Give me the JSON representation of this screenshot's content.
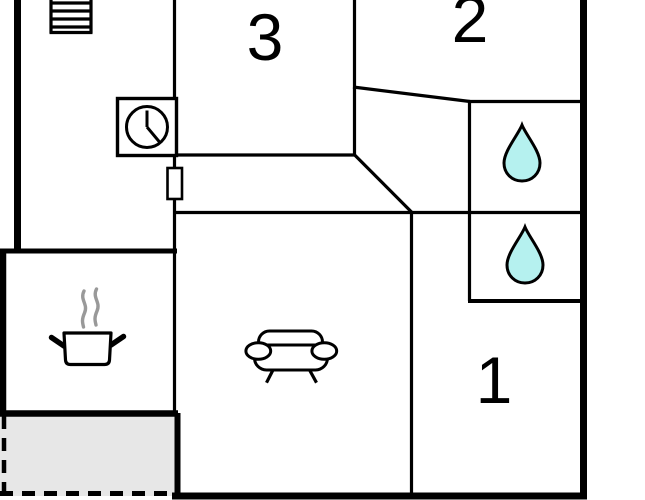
{
  "plan": {
    "name": "apartment-floor-plan",
    "rooms": [
      {
        "id": "room-1",
        "label": "1"
      },
      {
        "id": "room-2",
        "label": "2"
      },
      {
        "id": "room-3",
        "label": "3"
      }
    ],
    "icons": [
      {
        "name": "stairs-icon",
        "area": "entry-hall"
      },
      {
        "name": "clock-icon",
        "area": "entry-hall"
      },
      {
        "name": "door-icon",
        "area": "hallway"
      },
      {
        "name": "water-drop-icon",
        "area": "bathroom-upper"
      },
      {
        "name": "water-drop-icon",
        "area": "bathroom-lower"
      },
      {
        "name": "cooking-pot-icon",
        "area": "kitchen"
      },
      {
        "name": "steam-icon",
        "area": "kitchen"
      },
      {
        "name": "sofa-icon",
        "area": "living-room"
      }
    ],
    "terrace": {
      "style": "dashed-outline"
    },
    "colors": {
      "wall": "#000000",
      "water_drop_fill": "#b5f1ef",
      "terrace_fill": "#e7e7e7",
      "steam": "#999999",
      "background": "#ffffff"
    }
  }
}
